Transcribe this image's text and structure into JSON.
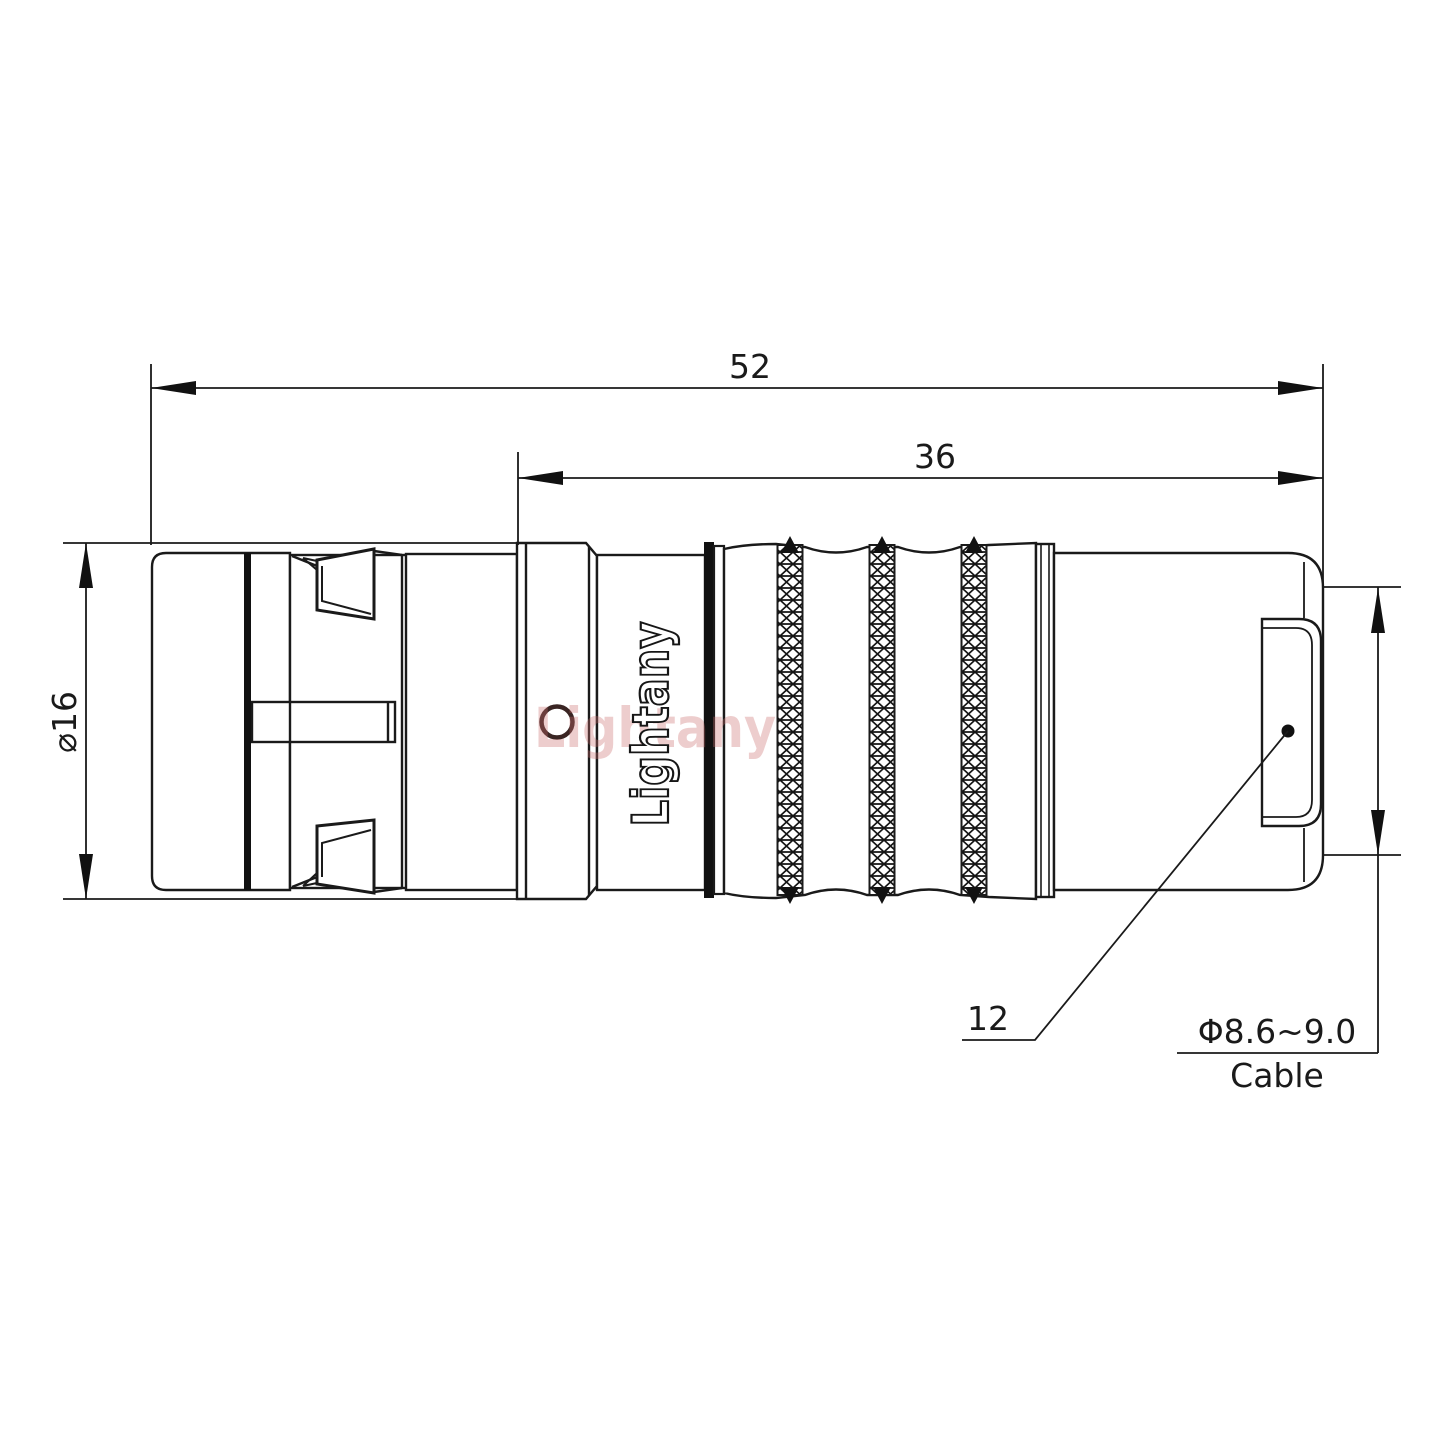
{
  "drawing": {
    "title": "connector-technical-drawing",
    "watermark": "Lightany",
    "engraving": "Lightany",
    "dimensions": {
      "overall_length": "52",
      "rear_length": "36",
      "body_diameter": "⌀16",
      "boot_ref": "12",
      "cable_diameter": "Φ8.6~9.0",
      "cable_label": "Cable"
    },
    "colors": {
      "line": "#1a1a1a",
      "watermark_pink": "#c96b6b",
      "seal_ring": "#3a2523"
    }
  }
}
